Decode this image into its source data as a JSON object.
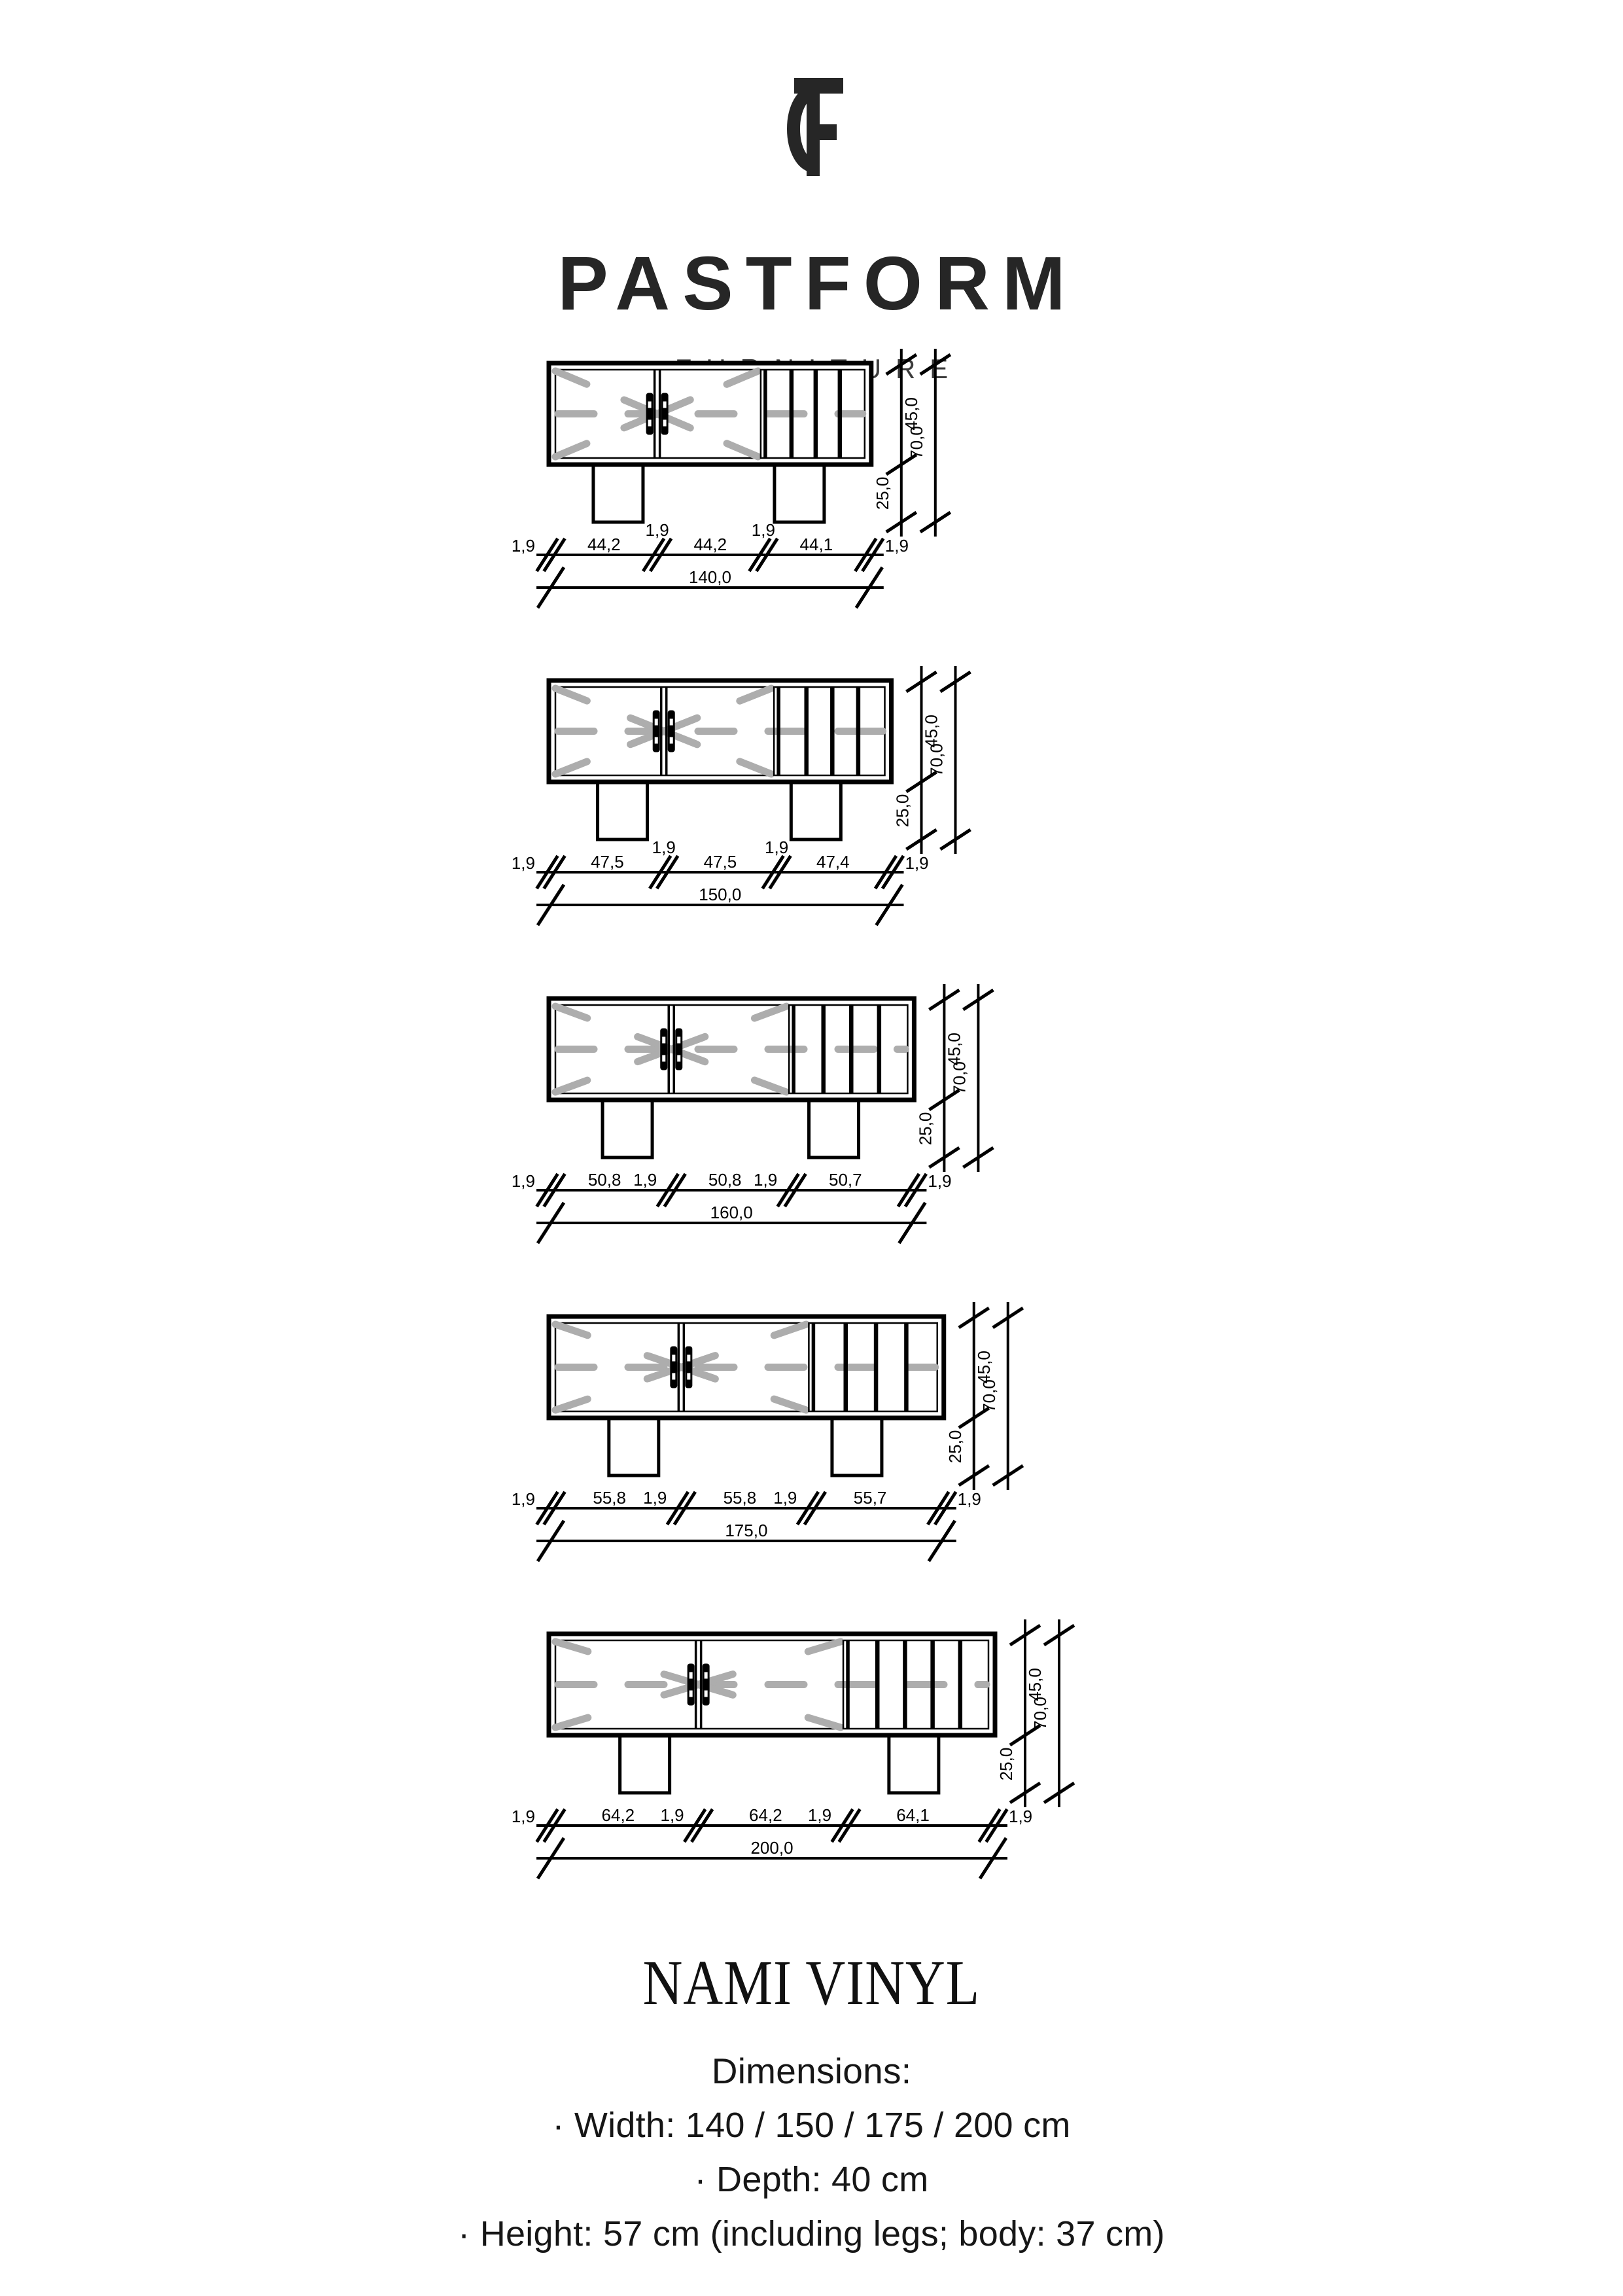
{
  "header": {
    "brand": "PASTFORM",
    "subtitle": "FURNITURE",
    "logo": "pastform-monogram"
  },
  "drawings": [
    {
      "name": "nami-vinyl-140",
      "total_cm": 140,
      "total_label": "140,0",
      "segments_cm": [
        1.9,
        44.2,
        1.9,
        44.2,
        1.9,
        44.1,
        1.9
      ],
      "segment_labels": [
        "1,9",
        "44,2",
        "1,9",
        "44,2",
        "1,9",
        "44,1",
        "1,9"
      ],
      "heights": {
        "body": "45,0",
        "legs": "25,0",
        "total": "70,0"
      },
      "slat_columns": 4,
      "dim_label_style": "raised"
    },
    {
      "name": "nami-vinyl-150",
      "total_cm": 150,
      "total_label": "150,0",
      "segments_cm": [
        1.9,
        47.5,
        1.9,
        47.5,
        1.9,
        47.4,
        1.9
      ],
      "segment_labels": [
        "1,9",
        "47,5",
        "1,9",
        "47,5",
        "1,9",
        "47,4",
        "1,9"
      ],
      "heights": {
        "body": "45,0",
        "legs": "25,0",
        "total": "70,0"
      },
      "slat_columns": 4,
      "dim_label_style": "raised"
    },
    {
      "name": "nami-vinyl-160",
      "total_cm": 160,
      "total_label": "160,0",
      "segments_cm": [
        1.9,
        50.8,
        1.9,
        50.8,
        1.9,
        50.7,
        1.9
      ],
      "segment_labels": [
        "1,9",
        "50,8",
        "1,9",
        "50,8",
        "1,9",
        "50,7",
        "1,9"
      ],
      "heights": {
        "body": "45,0",
        "legs": "25,0",
        "total": "70,0"
      },
      "slat_columns": 4,
      "dim_label_style": "inline"
    },
    {
      "name": "nami-vinyl-175",
      "total_cm": 175,
      "total_label": "175,0",
      "segments_cm": [
        1.9,
        55.8,
        1.9,
        55.8,
        1.9,
        55.7,
        1.9
      ],
      "segment_labels": [
        "1,9",
        "55,8",
        "1,9",
        "55,8",
        "1,9",
        "55,7",
        "1,9"
      ],
      "heights": {
        "body": "45,0",
        "legs": "25,0",
        "total": "70,0"
      },
      "slat_columns": 4,
      "dim_label_style": "inline"
    },
    {
      "name": "nami-vinyl-200",
      "total_cm": 200,
      "total_label": "200,0",
      "segments_cm": [
        1.9,
        64.2,
        1.9,
        64.2,
        1.9,
        64.1,
        1.9
      ],
      "segment_labels": [
        "1,9",
        "64,2",
        "1,9",
        "64,2",
        "1,9",
        "64,1",
        "1,9"
      ],
      "heights": {
        "body": "45,0",
        "legs": "25,0",
        "total": "70,0"
      },
      "slat_columns": 5,
      "dim_label_style": "inline"
    }
  ],
  "product": {
    "title": "NAMI VINYL",
    "heading": "Dimensions:",
    "specs": [
      "· Width: 140 / 150 / 175 / 200 cm",
      "· Depth: 40 cm",
      "· Height: 57 cm (including legs; body: 37 cm)"
    ]
  },
  "colors": {
    "line": "#000000",
    "gray_marks": "#adadad",
    "logo": "#262626"
  }
}
